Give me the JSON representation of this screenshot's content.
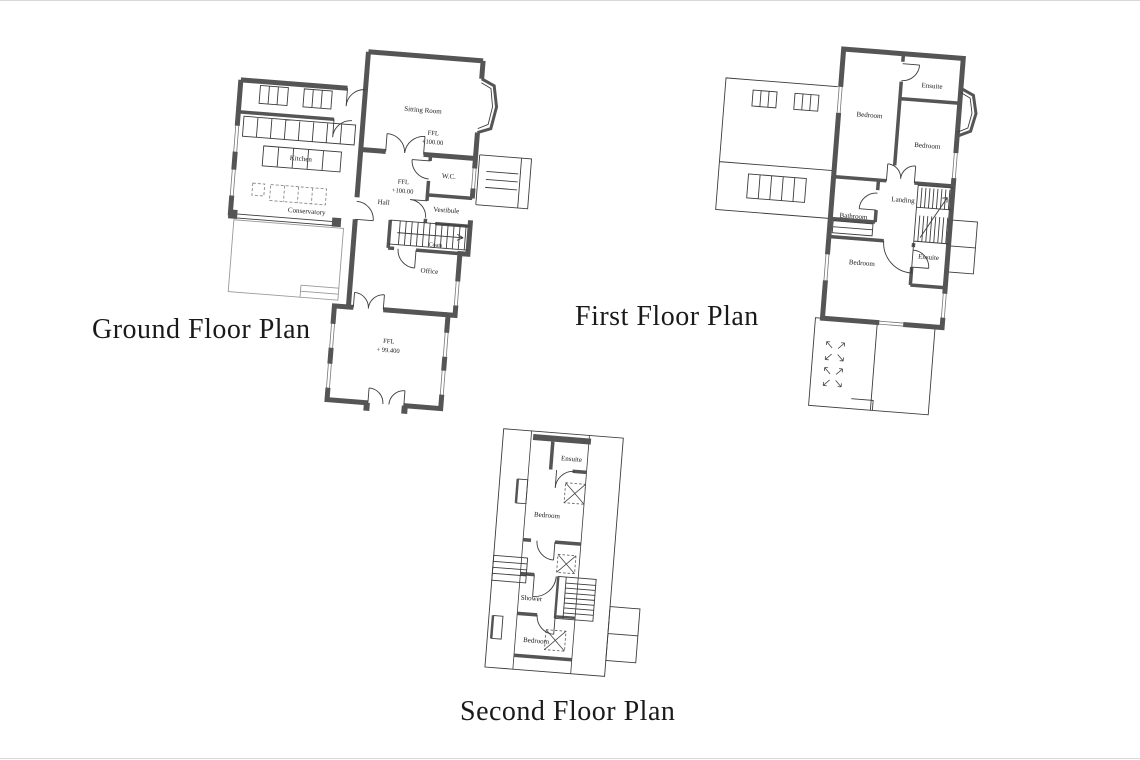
{
  "document": {
    "background_color": "#ffffff",
    "wall_color": "#555555",
    "line_color": "#3c3c3c",
    "label_color": "#222222",
    "title_color": "#1a1a1a"
  },
  "ground_floor": {
    "title": "Ground Floor Plan",
    "labels": {
      "sitting_room": "Sitting Room",
      "ffl_sitting_label": "FFL",
      "ffl_sitting_value": "+100.00",
      "wc": "W.C.",
      "ffl_hall_label": "FFL",
      "ffl_hall_value": "+100.00",
      "vestibule": "Vestibule",
      "hall": "Hall",
      "kitchen": "Kitchen",
      "conservatory": "Conservatory",
      "coats": "Coats",
      "office": "Office",
      "ffl_lower_label": "FFL",
      "ffl_lower_value": "+ 99.400"
    }
  },
  "first_floor": {
    "title": "First Floor Plan",
    "labels": {
      "bedroom_top": "Bedroom",
      "ensuite_top": "Ensuite",
      "bedroom_right": "Bedroom",
      "landing": "Landing",
      "bathroom": "Bathroom",
      "bedroom_bottom": "Bedroom",
      "ensuite_bottom": "Ensuite"
    }
  },
  "second_floor": {
    "title": "Second Floor Plan",
    "labels": {
      "ensuite": "Ensuite",
      "bedroom_top": "Bedroom",
      "shower": "Shower",
      "bedroom_bottom": "Bedroom"
    }
  }
}
